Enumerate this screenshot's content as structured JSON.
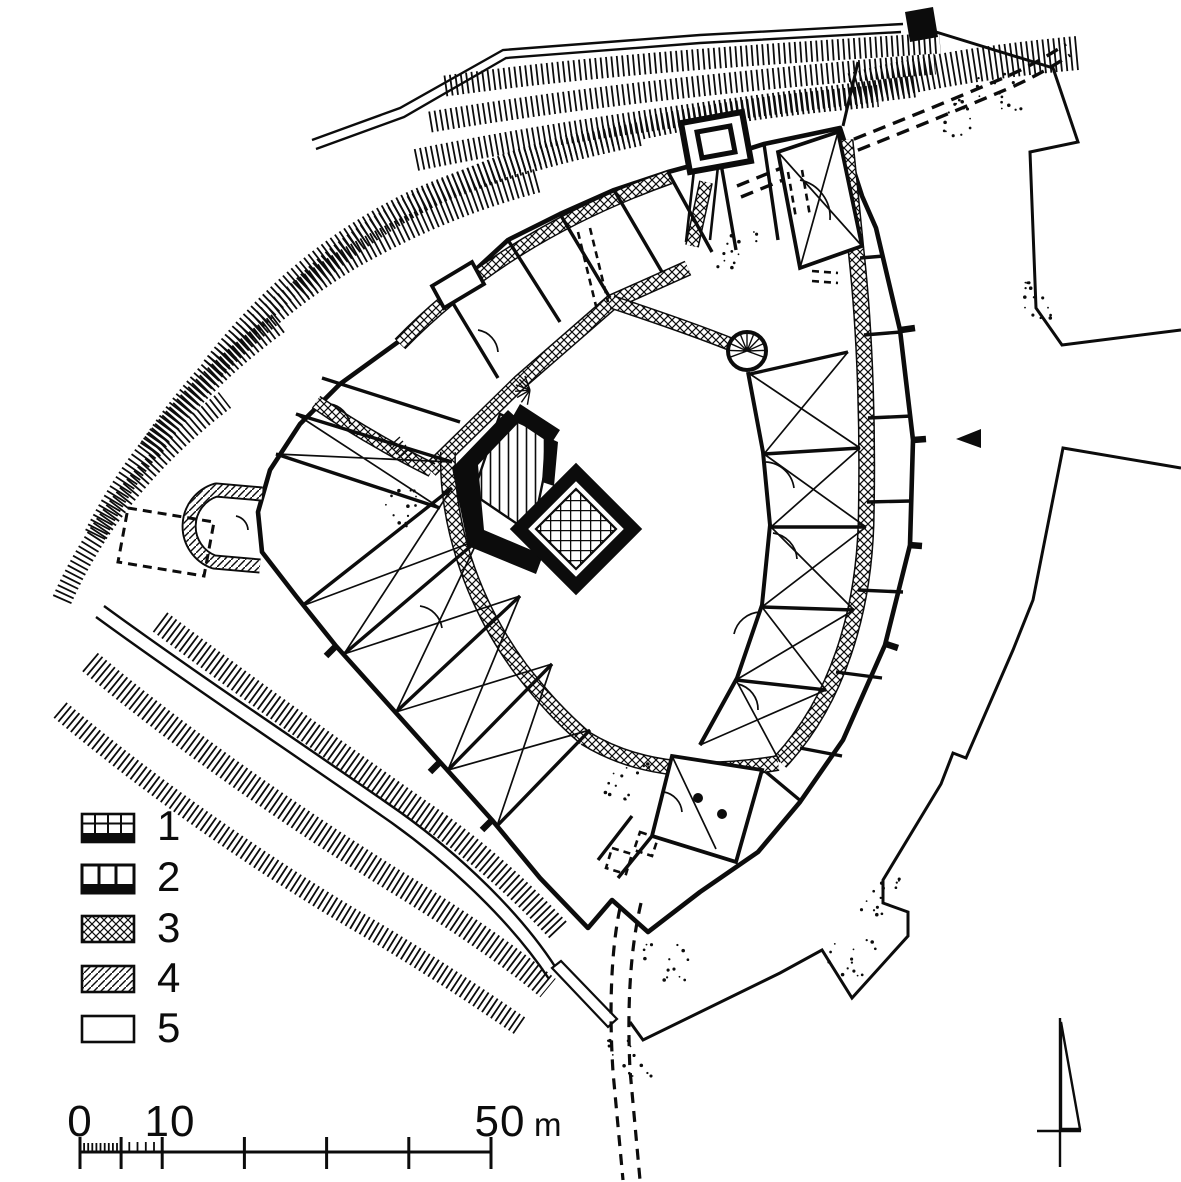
{
  "figure": {
    "kind": "site-plan-line-drawing",
    "ink_color": "#0c0c0c",
    "paper_color": "#ffffff"
  },
  "legend": {
    "items": [
      {
        "label": "1",
        "pattern": "masonry-grid-with-black-base"
      },
      {
        "label": "2",
        "pattern": "vertical-cells-with-black-base"
      },
      {
        "label": "3",
        "pattern": "crosshatch"
      },
      {
        "label": "4",
        "pattern": "diagonal-hatch"
      },
      {
        "label": "5",
        "pattern": "open-outline"
      }
    ]
  },
  "scale_bar": {
    "tick_labels": [
      "0",
      "10",
      "50"
    ],
    "unit_label": "m"
  },
  "markers": {
    "north_arrow": "half-arrow-north-indicator",
    "entrance_marker": "solid-left-pointing-triangle"
  }
}
